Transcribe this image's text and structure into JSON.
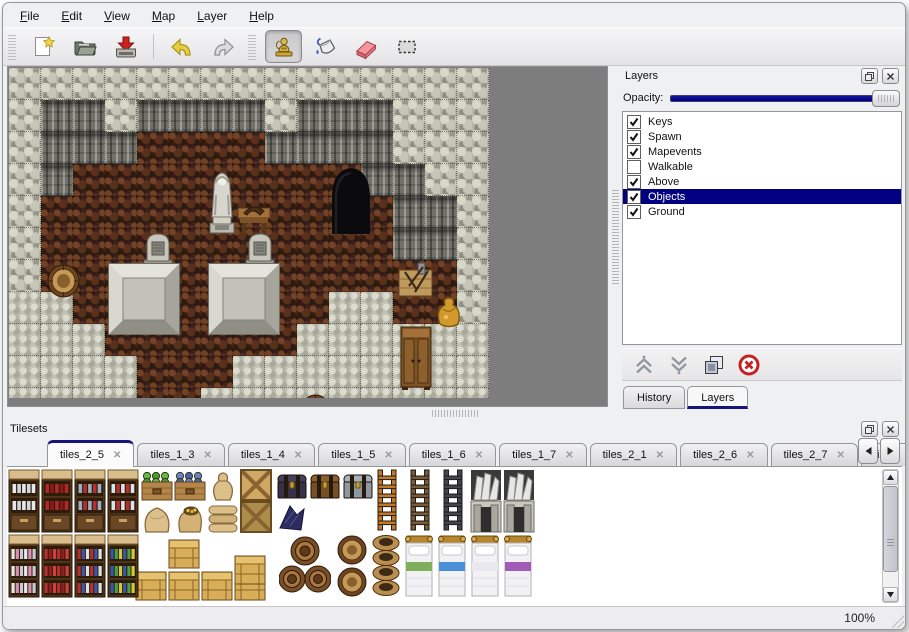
{
  "colors": {
    "selection": "#000080",
    "slider_fill": "#00008b",
    "tab_accent": "#16167a",
    "map_background": "#7d7d7d"
  },
  "menu": {
    "items": [
      "File",
      "Edit",
      "View",
      "Map",
      "Layer",
      "Help"
    ]
  },
  "toolbar": {
    "groups": [
      {
        "buttons": [
          {
            "name": "new-file",
            "selected": false
          },
          {
            "name": "open",
            "selected": false
          },
          {
            "name": "save",
            "selected": false
          },
          {
            "name": "separator"
          },
          {
            "name": "undo",
            "selected": false
          },
          {
            "name": "redo",
            "selected": false
          }
        ]
      },
      {
        "buttons": [
          {
            "name": "stamp",
            "selected": true
          },
          {
            "name": "fill",
            "selected": false
          },
          {
            "name": "eraser",
            "selected": false
          },
          {
            "name": "select",
            "selected": false
          }
        ]
      }
    ]
  },
  "map": {
    "tile_size": 32,
    "cols": 15,
    "rows": 11,
    "grid": [
      "WWWWWWWWWWWWWWW",
      "WFFWFFFFWFCFWWW",
      "WFFFBBBBFFCFWWW",
      "WFBBBBBBBBBFFWW",
      "WBBBBBBBBBBBFFW",
      "WBBBBBBBBBBBFFW",
      "WBBBBBBBBBBBBBW",
      "SSBBBBBBBBSSBBW",
      "SSSBBBBBBSSSSSS",
      "SSSSBBBSSSSSSSS",
      "SSSSBBSSSSSSSSS"
    ],
    "objects": [
      {
        "type": "cave",
        "x": 320,
        "y": 96,
        "w": 44,
        "h": 70
      },
      {
        "type": "statue",
        "x": 194,
        "y": 99,
        "w": 38,
        "h": 68
      },
      {
        "type": "table",
        "x": 227,
        "y": 132,
        "w": 36,
        "h": 36
      },
      {
        "type": "tombstone",
        "x": 132,
        "y": 162,
        "w": 34,
        "h": 36
      },
      {
        "type": "tombstone",
        "x": 234,
        "y": 162,
        "w": 34,
        "h": 36
      },
      {
        "type": "platform",
        "x": 99,
        "y": 195,
        "w": 72,
        "h": 72
      },
      {
        "type": "platform",
        "x": 199,
        "y": 195,
        "w": 72,
        "h": 72
      },
      {
        "type": "barreltop",
        "x": 38,
        "y": 196,
        "w": 33,
        "h": 34
      },
      {
        "type": "cratetools",
        "x": 388,
        "y": 192,
        "w": 37,
        "h": 38
      },
      {
        "type": "goldbag",
        "x": 424,
        "y": 226,
        "w": 31,
        "h": 34
      },
      {
        "type": "wardrobe",
        "x": 390,
        "y": 257,
        "w": 34,
        "h": 66
      },
      {
        "type": "barreltop",
        "x": 291,
        "y": 326,
        "w": 31,
        "h": 34
      }
    ]
  },
  "layers_panel": {
    "title": "Layers",
    "opacity_label": "Opacity:",
    "opacity_percent": 100,
    "layers": [
      {
        "name": "Keys",
        "checked": true,
        "selected": false
      },
      {
        "name": "Spawn",
        "checked": true,
        "selected": false
      },
      {
        "name": "Mapevents",
        "checked": true,
        "selected": false
      },
      {
        "name": "Walkable",
        "checked": false,
        "selected": false
      },
      {
        "name": "Above",
        "checked": true,
        "selected": false
      },
      {
        "name": "Objects",
        "checked": true,
        "selected": true
      },
      {
        "name": "Ground",
        "checked": true,
        "selected": false
      }
    ],
    "actions": [
      "raise-layer",
      "lower-layer",
      "duplicate-layer",
      "delete-layer"
    ],
    "tabs": [
      {
        "label": "History",
        "active": false
      },
      {
        "label": "Layers",
        "active": true
      }
    ]
  },
  "tilesets_panel": {
    "title": "Tilesets",
    "tabs": [
      {
        "label": "tiles_2_5",
        "active": true
      },
      {
        "label": "tiles_1_3",
        "active": false
      },
      {
        "label": "tiles_1_4",
        "active": false
      },
      {
        "label": "tiles_1_5",
        "active": false
      },
      {
        "label": "tiles_1_6",
        "active": false
      },
      {
        "label": "tiles_1_7",
        "active": false
      },
      {
        "label": "tiles_2_1",
        "active": false
      },
      {
        "label": "tiles_2_6",
        "active": false
      },
      {
        "label": "tiles_2_7",
        "active": false
      },
      {
        "label": "tiles_",
        "active": false
      }
    ],
    "items": [
      {
        "type": "cabinet",
        "variant": "dishes",
        "x": 1,
        "y": 2
      },
      {
        "type": "cabinet",
        "variant": "bottles",
        "x": 34,
        "y": 2
      },
      {
        "type": "cabinet",
        "variant": "jars",
        "x": 67,
        "y": 2
      },
      {
        "type": "cabinet",
        "variant": "mixed",
        "x": 100,
        "y": 2
      },
      {
        "type": "produce",
        "variant": "green",
        "x": 134,
        "y": 2
      },
      {
        "type": "produce",
        "variant": "blue",
        "x": 167,
        "y": 2
      },
      {
        "type": "sack",
        "x": 200,
        "y": 2
      },
      {
        "type": "cratex",
        "variant": "light",
        "x": 233,
        "y": 2
      },
      {
        "type": "chest",
        "variant": "dark",
        "x": 269,
        "y": 2
      },
      {
        "type": "chest",
        "variant": "brown",
        "x": 302,
        "y": 2
      },
      {
        "type": "chest",
        "variant": "gray",
        "x": 335,
        "y": 2
      },
      {
        "type": "sackbig",
        "x": 134,
        "y": 34
      },
      {
        "type": "sackgold",
        "x": 167,
        "y": 34
      },
      {
        "type": "sackpile",
        "x": 200,
        "y": 34
      },
      {
        "type": "cratex",
        "variant": "dark",
        "x": 233,
        "y": 34
      },
      {
        "type": "debris",
        "x": 269,
        "y": 34
      },
      {
        "type": "ladder",
        "color": "#c87820",
        "x": 364,
        "y": 2
      },
      {
        "type": "ladder",
        "color": "#7a5a30",
        "x": 397,
        "y": 2
      },
      {
        "type": "ladder",
        "color": "#44444c",
        "x": 430,
        "y": 2
      },
      {
        "type": "gate",
        "x": 463,
        "y": 2
      },
      {
        "type": "gate",
        "x": 496,
        "y": 2
      },
      {
        "type": "shelf",
        "variant": "jars",
        "x": 1,
        "y": 67
      },
      {
        "type": "shelf",
        "variant": "red",
        "x": 34,
        "y": 67
      },
      {
        "type": "shelf",
        "variant": "mixed",
        "x": 67,
        "y": 67
      },
      {
        "type": "shelf",
        "variant": "blue",
        "x": 100,
        "y": 67
      },
      {
        "type": "crate",
        "x": 161,
        "y": 70
      },
      {
        "type": "crate",
        "x": 227,
        "y": 86
      },
      {
        "type": "crate",
        "x": 128,
        "y": 102
      },
      {
        "type": "crate",
        "x": 161,
        "y": 102
      },
      {
        "type": "crate",
        "x": 194,
        "y": 102
      },
      {
        "type": "crate",
        "x": 227,
        "y": 102
      },
      {
        "type": "barrels",
        "x": 272,
        "y": 67
      },
      {
        "type": "barreltop",
        "x": 330,
        "y": 68
      },
      {
        "type": "barreltop",
        "x": 330,
        "y": 100
      },
      {
        "type": "pots",
        "x": 364,
        "y": 67
      },
      {
        "type": "bed",
        "color": "#7fae5c",
        "x": 396,
        "y": 67
      },
      {
        "type": "bed",
        "color": "#4a90d9",
        "x": 429,
        "y": 67
      },
      {
        "type": "bed",
        "color": "#e8e8ee",
        "x": 462,
        "y": 67
      },
      {
        "type": "bed",
        "color": "#a05ab8",
        "x": 495,
        "y": 67
      }
    ]
  },
  "status_bar": {
    "zoom": "100%"
  }
}
